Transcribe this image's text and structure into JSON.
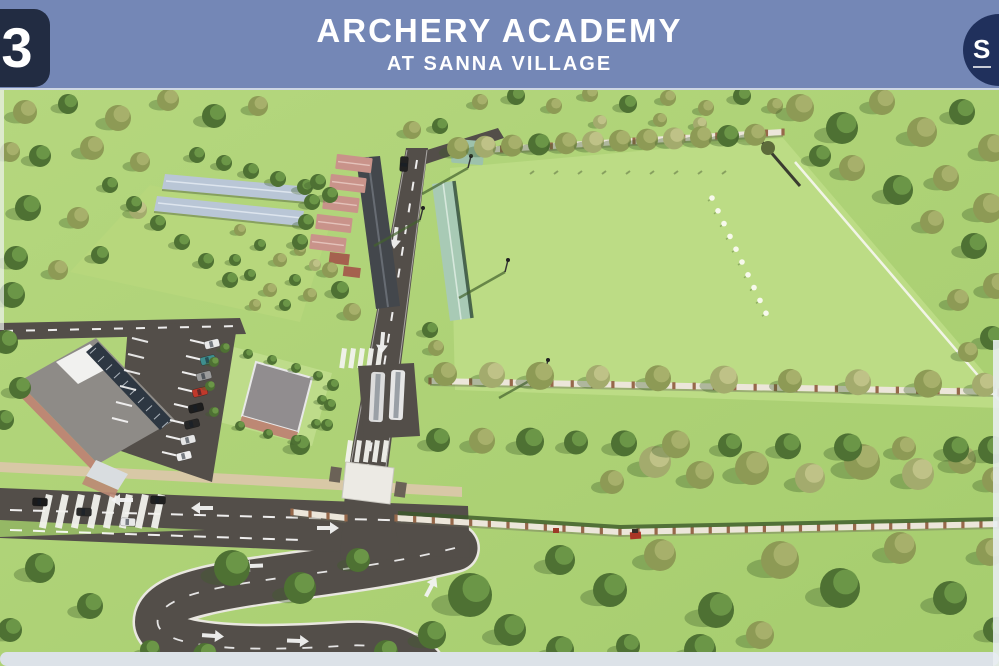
{
  "header": {
    "badge": "3",
    "title": "ARCHERY ACADEMY",
    "subtitle": "AT SANNA VILLAGE",
    "logo_monogram": "S"
  },
  "scene": {
    "description": "Aerial 3D architectural render of the Archery Academy site at Sanna Village",
    "features": [
      "archery practice field with diagonal line of white targets",
      "two greenhouses with pale blue roofs inside a walled garden",
      "row of academy buildings with terracotta roofs",
      "long hall with pale green roof beside internal road",
      "main administration building with grey roof and skylight",
      "angled car parking with parked cars",
      "two buses at bus bay and white entrance gate canopy",
      "internal roads with zebra crossings, arrows and dashed lanes",
      "boundary walls with brick piers lined with trees"
    ]
  },
  "colors": {
    "header_blue": "#7487b6",
    "badge_navy": "#222c42",
    "logo_navy": "#20305c",
    "text_white": "#ffffff",
    "grass": "#abd072",
    "field_green": "#bcdc85",
    "road": "#534e49",
    "tree_dark": "#4e7133",
    "tree_olive": "#8d9a55",
    "wall_tan": "#ece6da",
    "pier_brown": "#96684a",
    "roof_gray": "#8e8b87",
    "roof_terracotta": "#c9938a",
    "roof_green": "#a8cab5",
    "greenhouse_blue": "#b9c6d6",
    "plaza_tan": "#d8c8a6",
    "edge_light": "#dce2e8"
  }
}
